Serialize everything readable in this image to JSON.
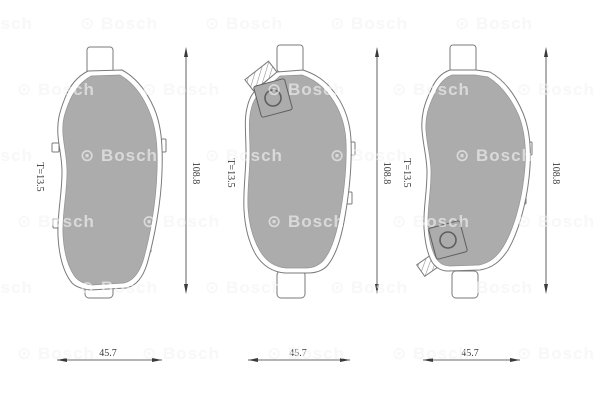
{
  "watermark": {
    "symbol": "⊙",
    "text": "Bosch"
  },
  "pads": [
    {
      "name": "left",
      "height_label": "108.8",
      "width_label": "45.7",
      "thickness_label": "T=13.5",
      "wear_indicator": "none"
    },
    {
      "name": "middle",
      "height_label": "108.8",
      "width_label": "45.7",
      "thickness_label": "T=13.5",
      "wear_indicator": "top-left"
    },
    {
      "name": "right",
      "height_label": "108.8",
      "width_label": "45.7",
      "thickness_label": "T=13.5",
      "wear_indicator": "bottom-left"
    }
  ],
  "colors": {
    "friction_material": "#acacac",
    "backplate": "#ffffff",
    "outline": "#7a7a7a",
    "dimension": "#3a3a3a",
    "watermark": "#e9e9e9"
  }
}
